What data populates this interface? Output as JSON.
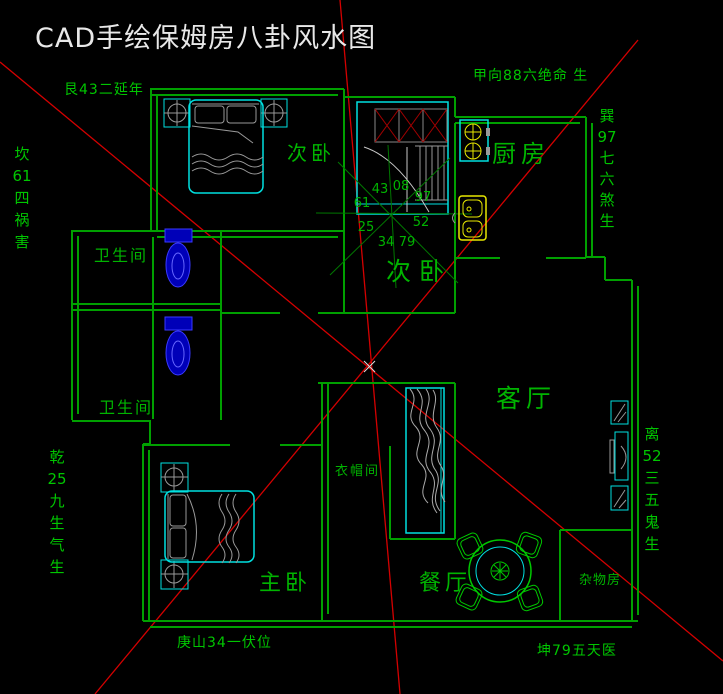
{
  "title": "CAD手绘保姆房八卦风水图",
  "annotations": {
    "top_label": "甲向88六绝命 生",
    "upper_left_label": "艮43二延年",
    "left_col": [
      "坎",
      "61",
      "四",
      "祸",
      "害"
    ],
    "lower_left_col": [
      "乾",
      "25",
      "九",
      "生",
      "气",
      "生"
    ],
    "upper_right_col": [
      "巽",
      "97",
      "七",
      "六",
      "煞",
      "生"
    ],
    "right_col": [
      "离",
      "52",
      "三",
      "五",
      "鬼",
      "生"
    ],
    "bottom_left_label": "庚山34一伏位",
    "bottom_right_label": "坤79五天医"
  },
  "compass": {
    "numbers": [
      "43",
      "08",
      "97",
      "61",
      "52",
      "25",
      "34",
      "79"
    ]
  },
  "rooms": {
    "bedroom_nw": "次卧",
    "bedroom_center": "次卧",
    "kitchen": "厨房",
    "bathroom_upper": "卫生间",
    "bathroom_lower": "卫生间",
    "living": "客厅",
    "cloakroom": "衣帽间",
    "master": "主卧",
    "dining": "餐厅",
    "storage": "杂物房"
  },
  "colors": {
    "background": "#000000",
    "wall_green": "#00A000",
    "text_green": "#00C600",
    "line_red": "#D40000",
    "furniture_cyan": "#00E0E0",
    "fixture_blue": "#3A3AFF",
    "appliance_yellow": "#E8E800",
    "detail_gray": "#9C9C9C",
    "title_white": "#E8E8E8"
  }
}
